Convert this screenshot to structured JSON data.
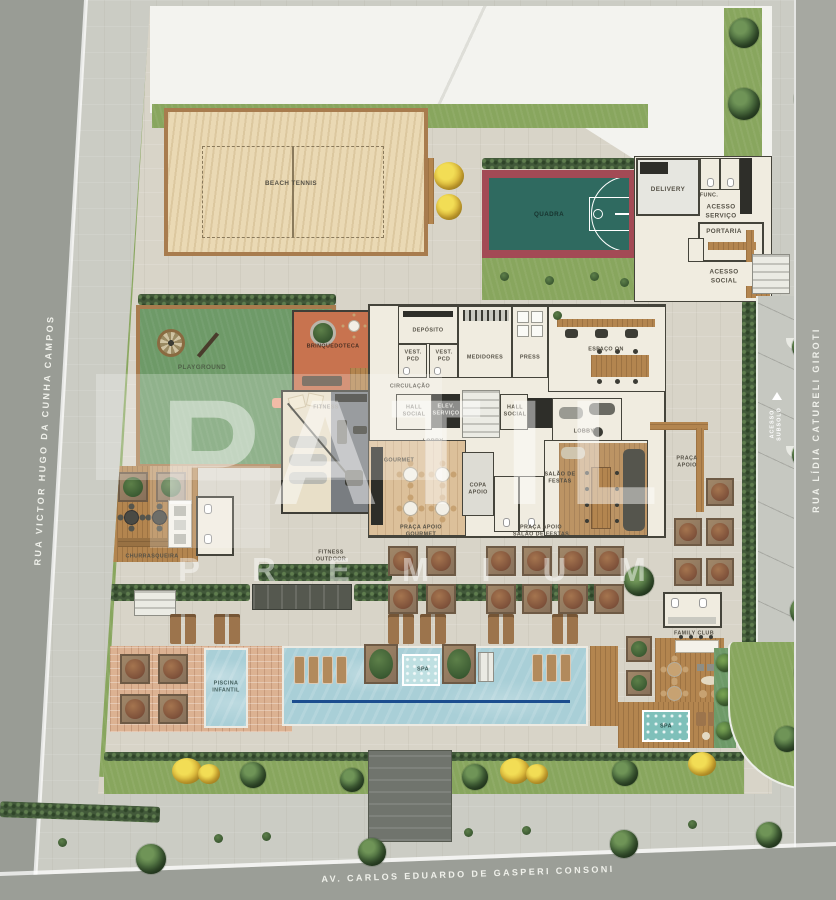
{
  "watermark": {
    "line1": "PATIL",
    "line2": "PREMIUM"
  },
  "streets": {
    "left": "RUA VICTOR HUGO DA CUNHA CAMPOS",
    "right": "RUA LÍDIA CATURELI GIROTI",
    "bottom": "AV. CARLOS EDUARDO DE GASPERI CONSONI"
  },
  "areas": {
    "beach_tennis": "BEACH TENNIS",
    "quadra": "QUADRA",
    "delivery": "DELIVERY",
    "func": "FUNC.",
    "acesso_servico": "ACESSO\nSERVIÇO",
    "portaria": "PORTARIA",
    "acesso_social": "ACESSO\nSOCIAL",
    "playground": "PLAYGROUND",
    "brinquedoteca": "BRINQUEDOTECA",
    "deposito": "DEPÓSITO",
    "vest_pcd": "VEST.\nPCD",
    "medidores": "MEDIDORES",
    "press": "PRESS",
    "espaco_on": "ESPAÇO ON",
    "circulacao": "CIRCULAÇÃO",
    "hall_social": "HALL\nSOCIAL",
    "elev_servico": "ELEV.\nSERVIÇO",
    "lobby": "LOBBY",
    "fitness": "FITNESS",
    "gourmet": "GOURMET",
    "salao_festas": "SALÃO DE\nFESTAS",
    "copa_apoio": "COPA\nAPOIO",
    "churrasqueira": "CHURRASQUEIRA",
    "fitness_outdoor": "FITNESS\nOUTDOOR",
    "praca_gourmet": "PRAÇA APOIO\nGOURMET",
    "praca_salao": "PRAÇA APOIO\nSALÃO DE  FESTAS",
    "praca_apoio": "PRAÇA\nAPOIO",
    "acesso_subsolo": "ACESSO\nSUBSOLO",
    "family_club": "FAMILY CLUB",
    "piscina_infantil": "PISCINA\nINFANTIL",
    "spa": "SPA"
  },
  "colors": {
    "grass": "#88a65e",
    "sand": "#ead9b4",
    "water": "#a9cfd7",
    "court_red": "#a34a55",
    "court_teal": "#2f6a60",
    "wood": "#b3854f",
    "street": "#9b9e97",
    "lane_line": "#1c4e8f",
    "playroom_orange": "#c8734f"
  }
}
